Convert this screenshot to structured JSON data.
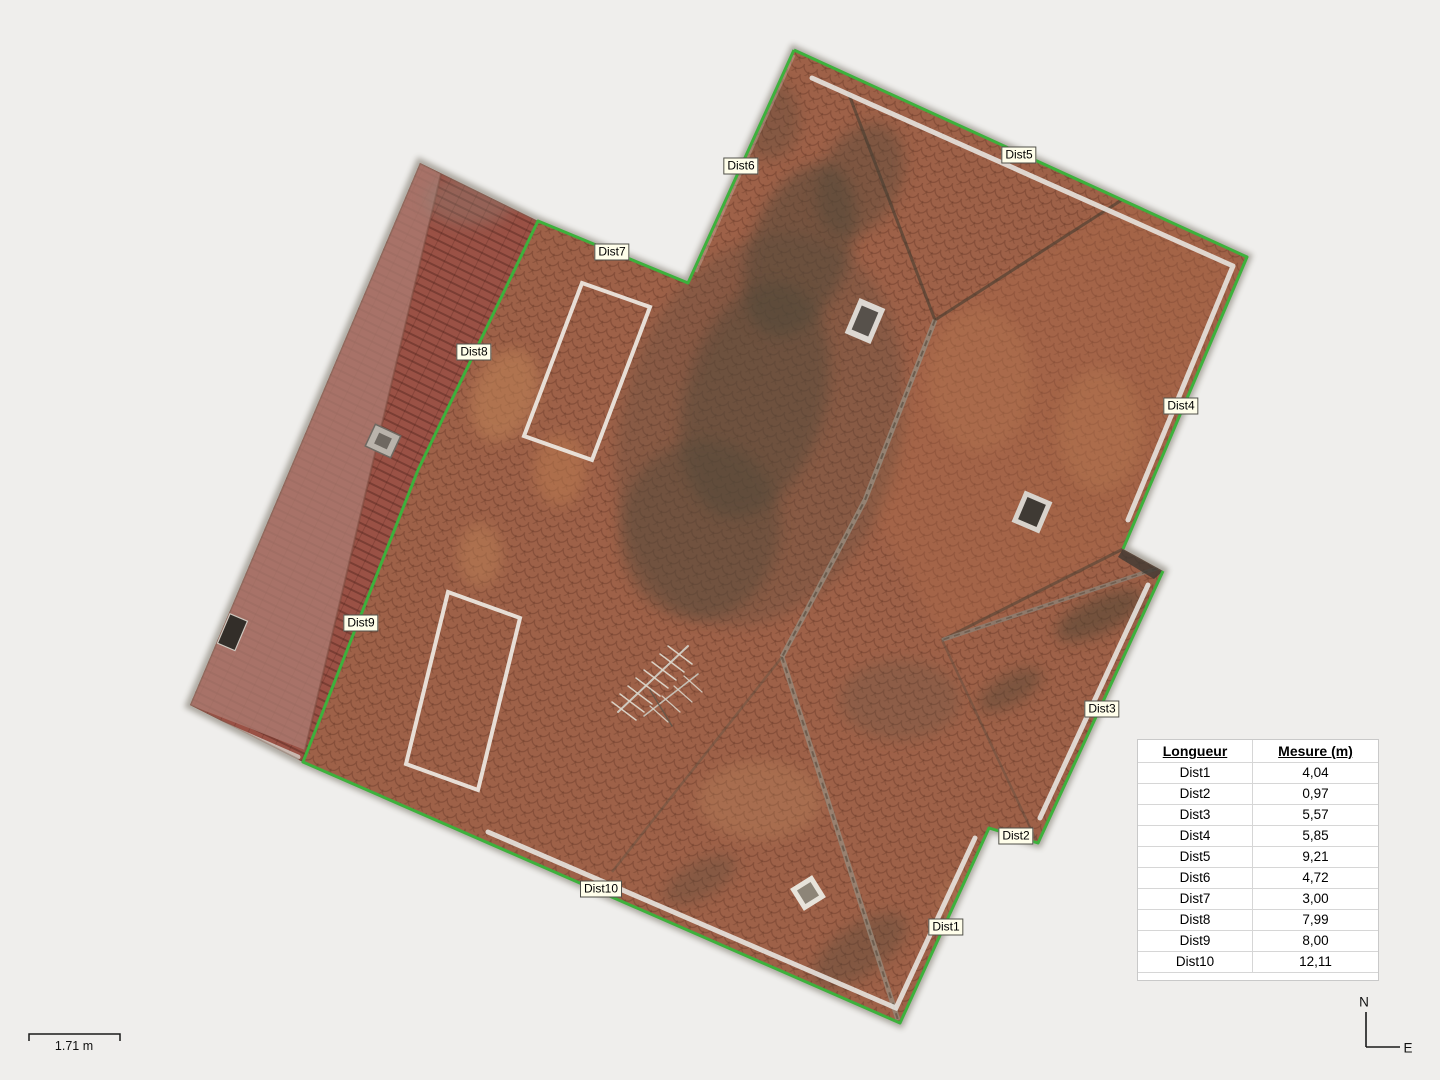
{
  "viewport": {
    "background": "#efeeec",
    "outline_color": "#3db13c",
    "description": "roof-orthomosaic-top-view"
  },
  "measure_labels": [
    {
      "text": "Dist1",
      "x": 946,
      "y": 927
    },
    {
      "text": "Dist2",
      "x": 1016,
      "y": 836
    },
    {
      "text": "Dist3",
      "x": 1102,
      "y": 709
    },
    {
      "text": "Dist4",
      "x": 1181,
      "y": 406
    },
    {
      "text": "Dist5",
      "x": 1019,
      "y": 155
    },
    {
      "text": "Dist6",
      "x": 741,
      "y": 166
    },
    {
      "text": "Dist7",
      "x": 612,
      "y": 252
    },
    {
      "text": "Dist8",
      "x": 474,
      "y": 352
    },
    {
      "text": "Dist9",
      "x": 361,
      "y": 623
    },
    {
      "text": "Dist10",
      "x": 601,
      "y": 889
    }
  ],
  "table": {
    "headers": [
      "Longueur",
      "Mesure (m)"
    ],
    "rows": [
      {
        "name": "Dist1",
        "value": "4,04"
      },
      {
        "name": "Dist2",
        "value": "0,97"
      },
      {
        "name": "Dist3",
        "value": "5,57"
      },
      {
        "name": "Dist4",
        "value": "5,85"
      },
      {
        "name": "Dist5",
        "value": "9,21"
      },
      {
        "name": "Dist6",
        "value": "4,72"
      },
      {
        "name": "Dist7",
        "value": "3,00"
      },
      {
        "name": "Dist8",
        "value": "7,99"
      },
      {
        "name": "Dist9",
        "value": "8,00"
      },
      {
        "name": "Dist10",
        "value": "12,11"
      }
    ]
  },
  "scale_bar": {
    "label": "1.71 m"
  },
  "compass": {
    "north": "N",
    "east": "E"
  }
}
